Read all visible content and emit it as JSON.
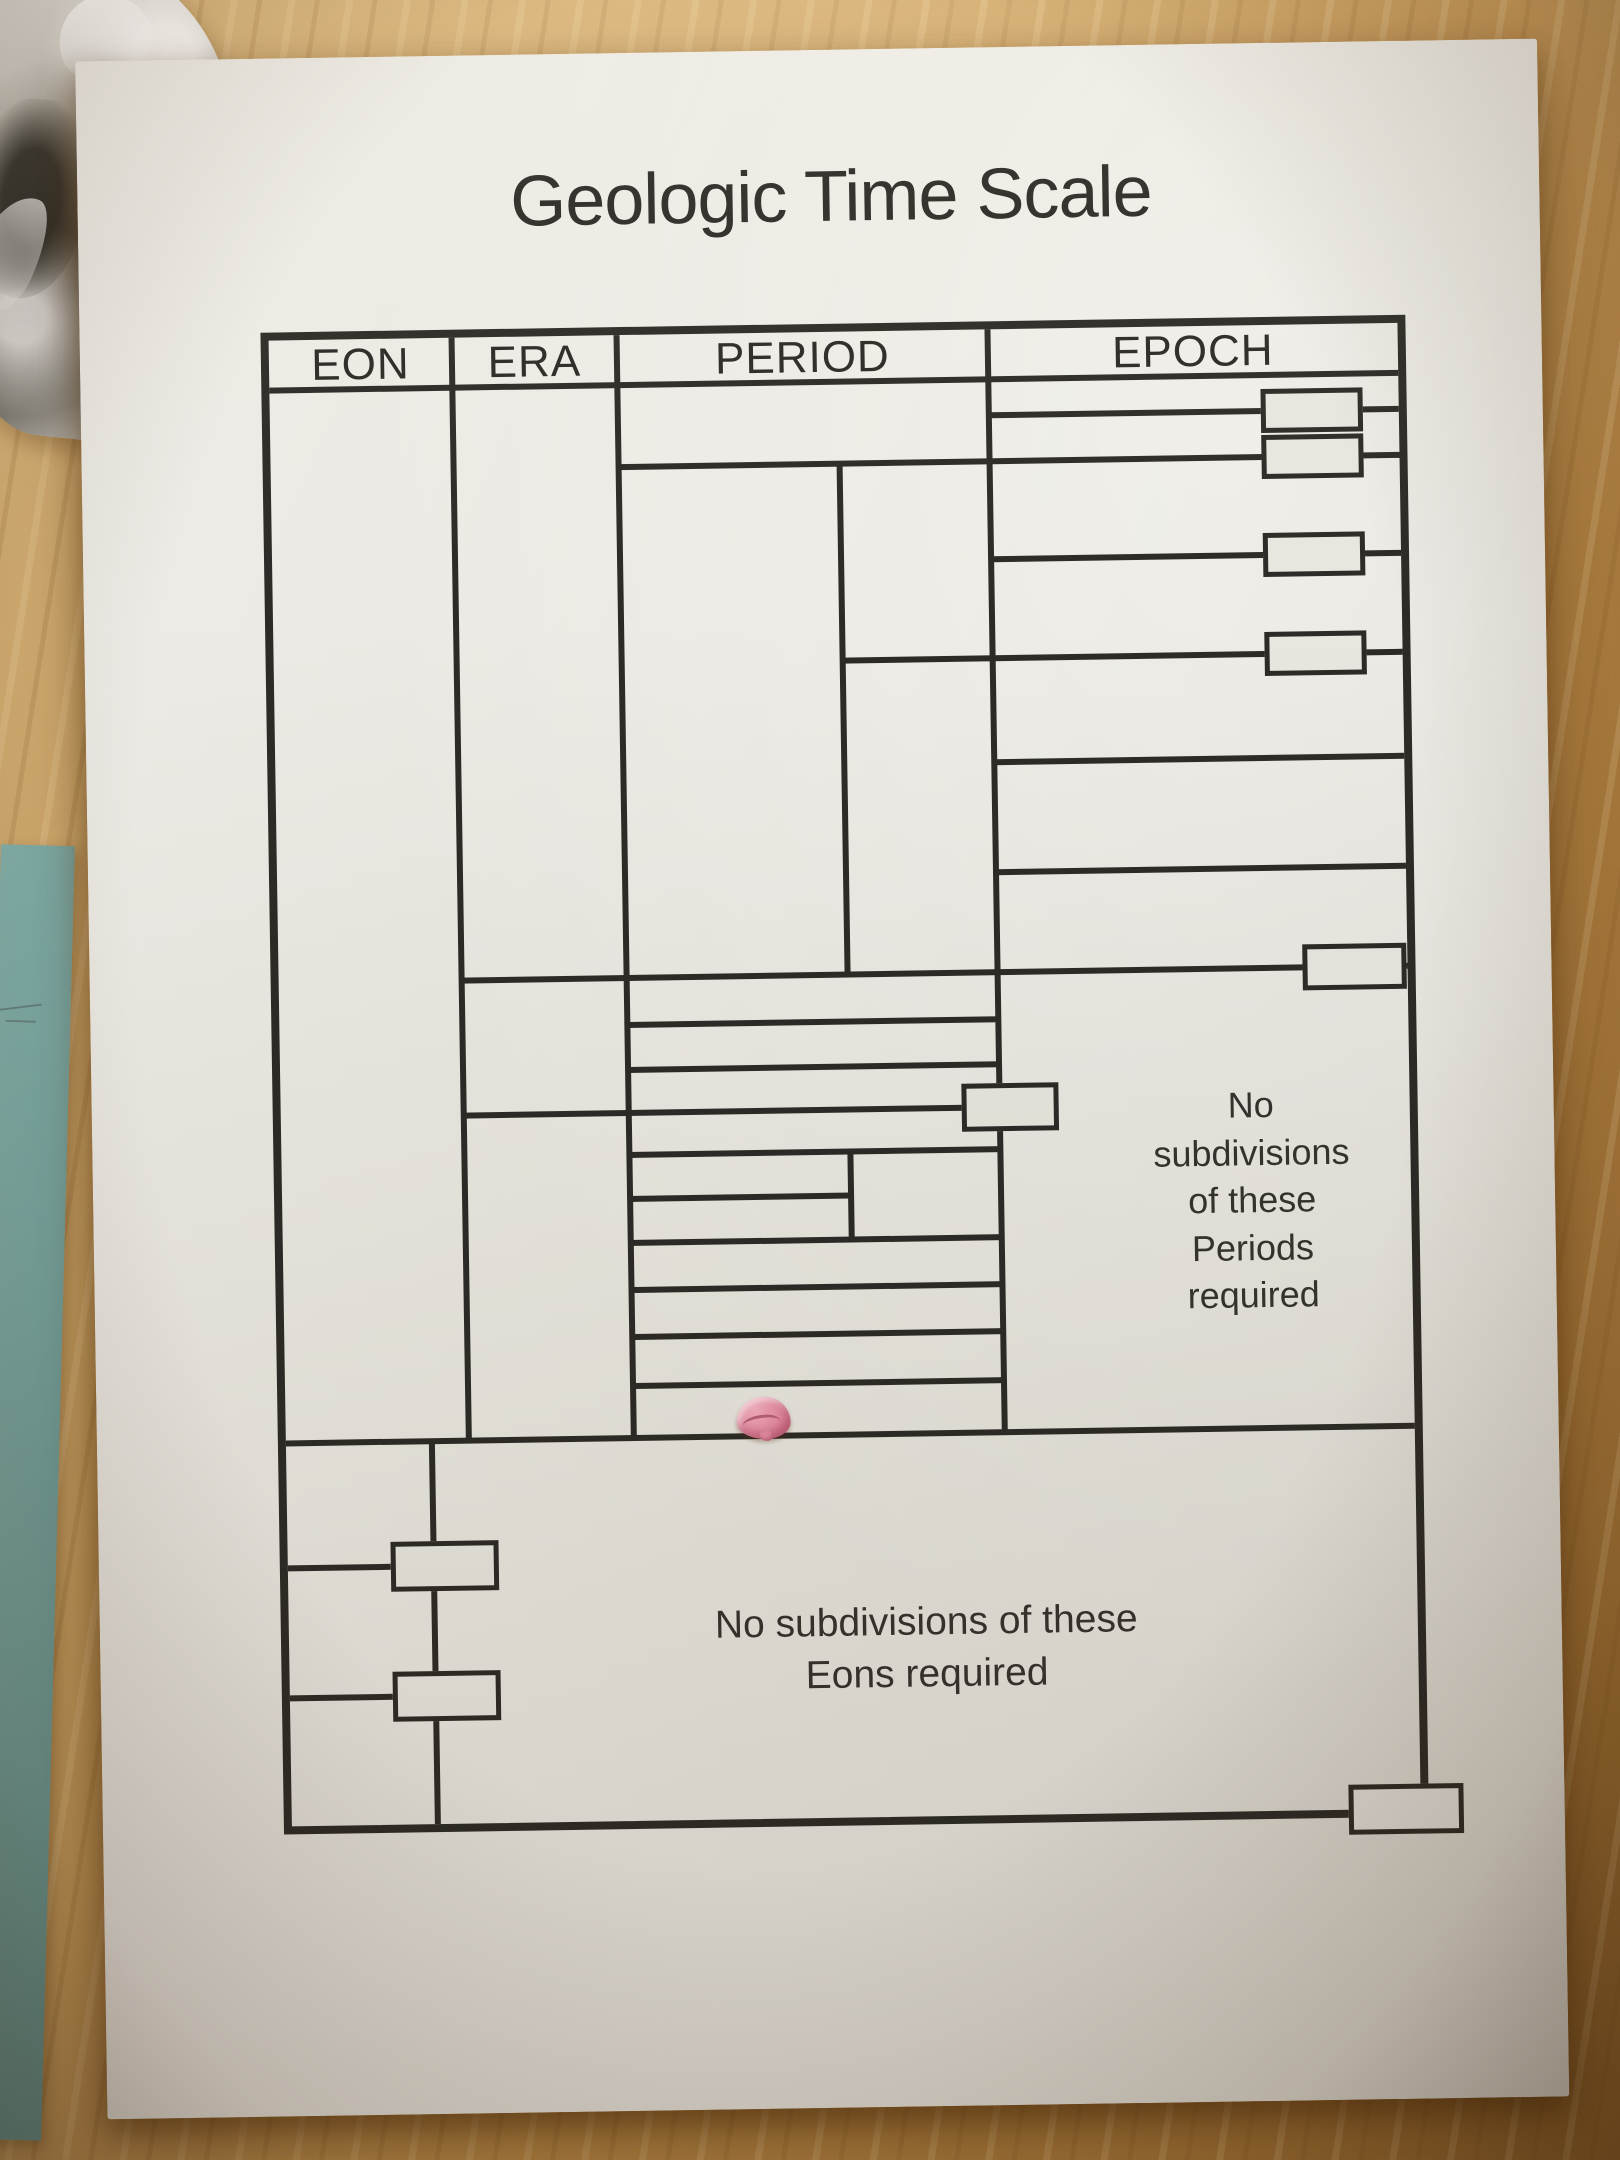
{
  "worksheet": {
    "title": "Geologic Time Scale",
    "columns": [
      "EON",
      "ERA",
      "PERIOD",
      "EPOCH"
    ],
    "notes": {
      "periods_note": "No\nsubdivisions\nof these\nPeriods\nrequired",
      "eons_note": "No subdivisions of these\nEons required"
    },
    "colors": {
      "ink": "#2c2b27",
      "paper": "#e9e7e0",
      "desk_wood": "#c79b58",
      "scrap_paper_teal": "#74a49f",
      "eraser_pink": "#e58ba1"
    }
  }
}
